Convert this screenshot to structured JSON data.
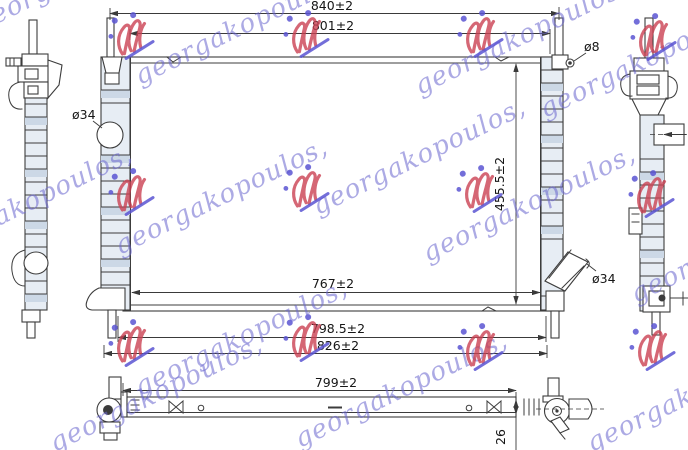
{
  "title": "radiator-technical-drawing",
  "watermark": {
    "text": "georgakopoulos,",
    "blue": "#6a66cf",
    "red": "#cb4152"
  },
  "dimensions": {
    "top_width": "840±2",
    "upper_width": "801±2",
    "height": "455.5±2",
    "core_width": "767±2",
    "lower_span": "798.5±2",
    "outer_span": "826±2",
    "bottom_length": "799±2",
    "bottom_thickness": "26"
  },
  "diameters": {
    "inlet": "ø34",
    "bleed": "ø8",
    "outlet": "ø34"
  },
  "colors": {
    "line": "#3c3c3c",
    "shading": "#e7edf4",
    "shading_band": "#ccd8e6",
    "background": "#ffffff"
  }
}
